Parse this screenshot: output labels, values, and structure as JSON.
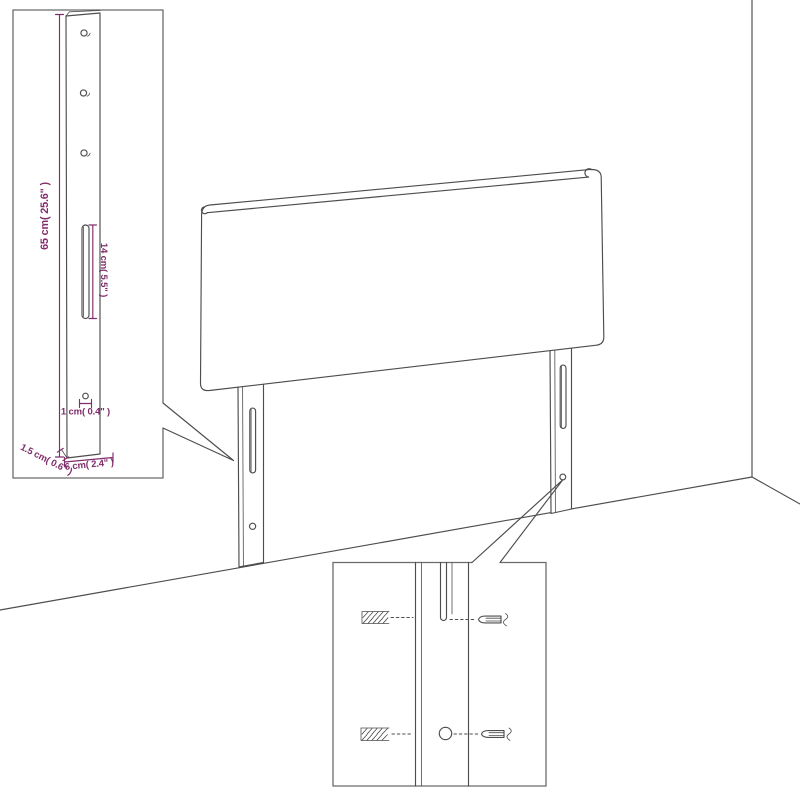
{
  "canvas": {
    "background": "#ffffff"
  },
  "colors": {
    "line": "#4d4d4d",
    "inset_border": "#6b6b6b",
    "dimension": "#802d6b"
  },
  "detail_post": {
    "height_label": "65 cm( 25.6\" )",
    "slot_label": "14 cm( 5.5\" )",
    "hole_label": "1 cm( 0.4\" )",
    "thickness_label": "1.5 cm( 0.6\" )",
    "width_label": "6 cm( 2.4\" )"
  }
}
